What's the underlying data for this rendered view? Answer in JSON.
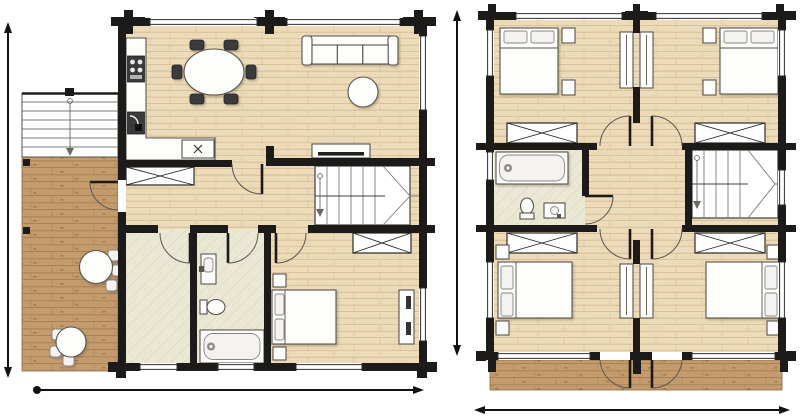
{
  "page": {
    "background": "#ffffff",
    "description": "Two-storey log house floor plans, no text labels"
  },
  "colors": {
    "wall": "#1c1b1a",
    "wood_base": "#ecdab8",
    "wood_grain": "#b08d5e",
    "deck_base": "#c49b6c",
    "deck_grain": "#9a7449",
    "tile_base": "#eae8d4",
    "tile_grain": "#d6d3b6",
    "line": "#57534c",
    "dim": "#111111",
    "page_bg": "#ffffff"
  },
  "plans": [
    {
      "id": "ground-floor-plan",
      "rooms": [
        "kitchen-dining",
        "living-room",
        "hall",
        "entry-hall",
        "bathroom",
        "bedroom",
        "terrace",
        "exterior-stairs"
      ],
      "furniture": [
        "kitchen-counter",
        "stove",
        "appliance",
        "counter-sink",
        "dining-table-with-6-chairs",
        "sofa",
        "coffee-table",
        "tv-sideboard",
        "u-staircase",
        "hall-wardrobe",
        "bedroom-wardrobe",
        "double-bed",
        "nightstands",
        "dresser",
        "washbasin",
        "toilet",
        "bathtub",
        "terrace-table-1",
        "terrace-table-2"
      ],
      "dimension_markers": [
        "vertical-extent-line",
        "horizontal-extent-line"
      ]
    },
    {
      "id": "upper-floor-plan",
      "rooms": [
        "bedroom-top-left",
        "bedroom-top-right",
        "bedroom-bottom-left",
        "bedroom-bottom-right",
        "bathroom",
        "central-landing",
        "balcony"
      ],
      "furniture": [
        "double-beds-x4",
        "nightstands",
        "wardrobes-x4",
        "built-in-closets-x2",
        "u-staircase",
        "bathtub",
        "washbasin",
        "toilet"
      ],
      "dimension_markers": [
        "vertical-extent-line",
        "horizontal-extent-line"
      ]
    }
  ]
}
